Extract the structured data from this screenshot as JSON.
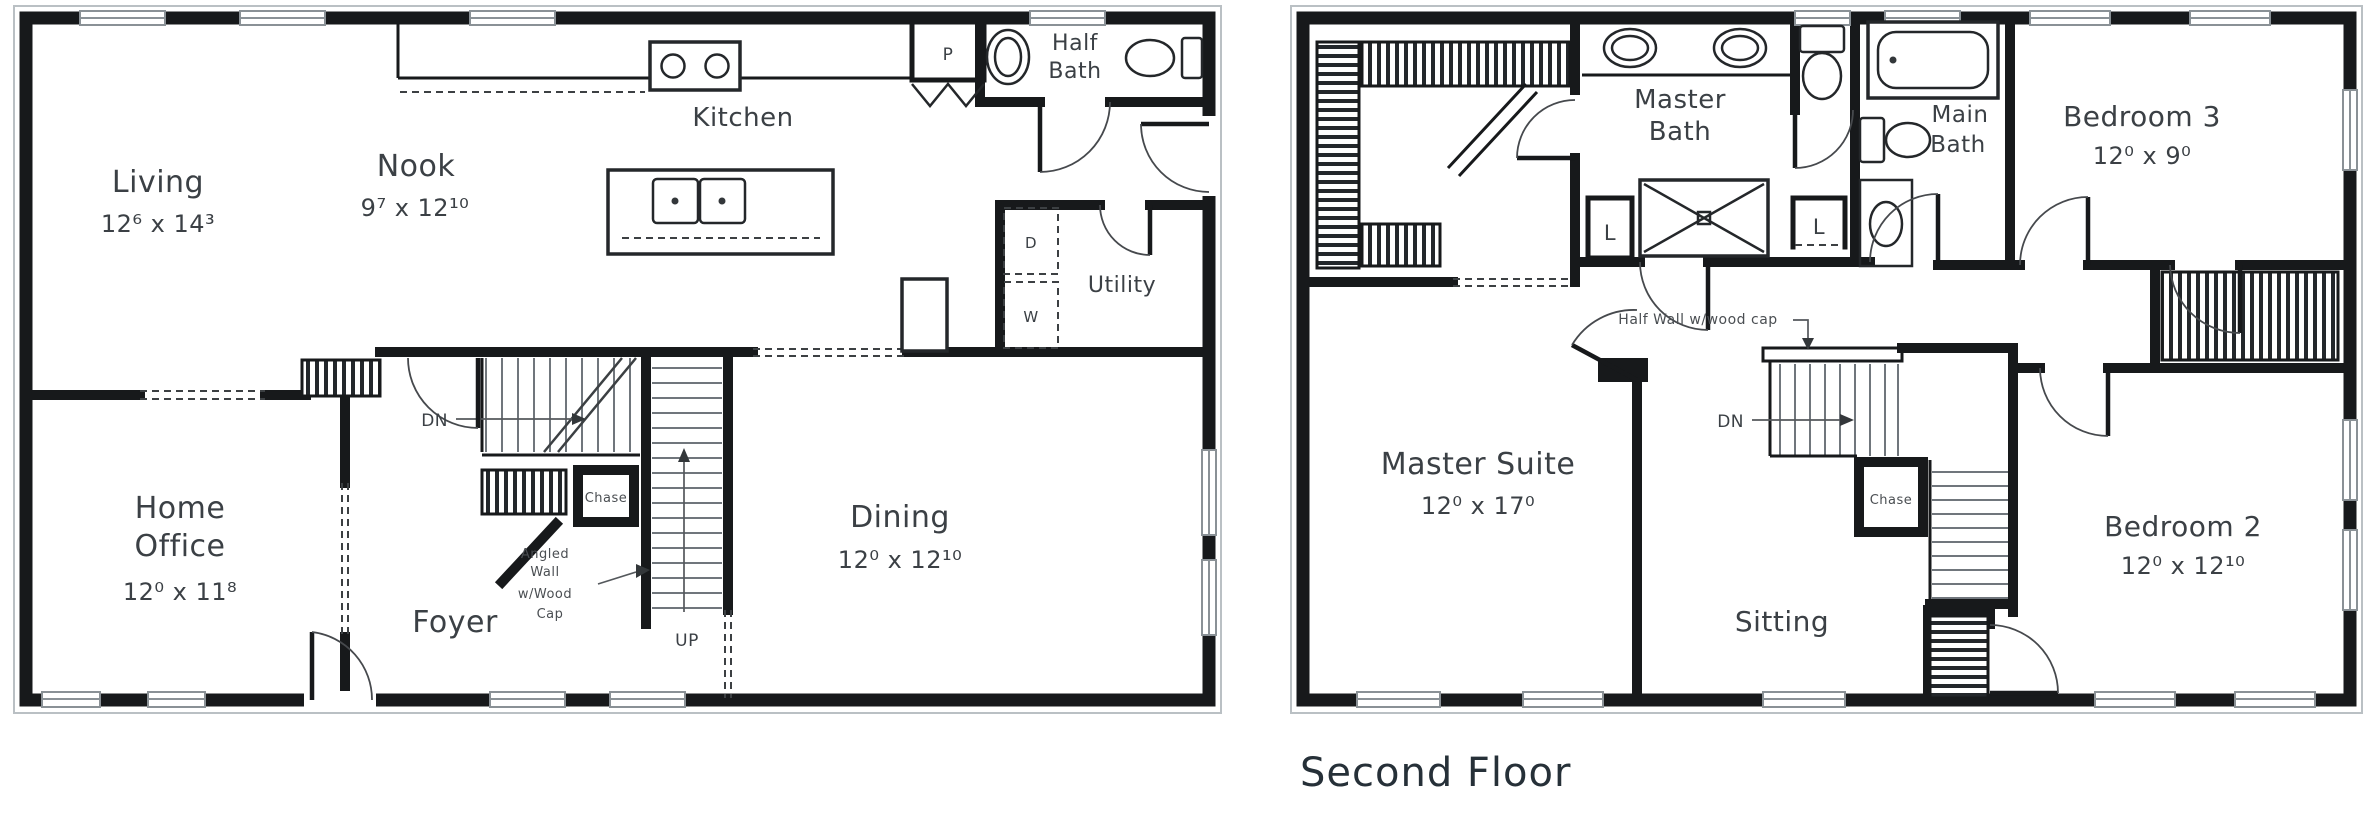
{
  "page": {
    "background": "#ffffff",
    "ink": "#17191b",
    "label_color": "#3b4045",
    "annotation_color": "#4a4e52",
    "window_color": "#8a9196"
  },
  "first_floor": {
    "rooms": {
      "living": {
        "name": "Living",
        "dims": "12⁶ x 14³"
      },
      "nook": {
        "name": "Nook",
        "dims": "9⁷ x 12¹⁰"
      },
      "kitchen": {
        "name": "Kitchen"
      },
      "half_bath": {
        "line1": "Half",
        "line2": "Bath"
      },
      "utility": {
        "name": "Utility"
      },
      "home_office": {
        "line1": "Home",
        "line2": "Office",
        "dims": "12⁰ x 11⁸"
      },
      "foyer": {
        "name": "Foyer"
      },
      "dining": {
        "name": "Dining",
        "dims": "12⁰ x 12¹⁰"
      }
    },
    "fixtures": {
      "pantry": "P",
      "dryer": "D",
      "washer": "W"
    },
    "stairs": {
      "down": "DN",
      "up": "UP",
      "chase": "Chase"
    },
    "annotations": {
      "angled_wall": [
        "Angled",
        "Wall",
        "w/Wood",
        "Cap"
      ]
    }
  },
  "second_floor": {
    "rooms": {
      "master_bath": {
        "line1": "Master",
        "line2": "Bath"
      },
      "main_bath": {
        "line1": "Main",
        "line2": "Bath"
      },
      "bedroom_3": {
        "name": "Bedroom 3",
        "dims": "12⁰ x 9⁰"
      },
      "master_suite": {
        "name": "Master Suite",
        "dims": "12⁰ x 17⁰"
      },
      "sitting": {
        "name": "Sitting"
      },
      "bedroom_2": {
        "name": "Bedroom 2",
        "dims": "12⁰ x 12¹⁰"
      }
    },
    "closets": {
      "linen_1": "L",
      "linen_2": "L"
    },
    "stairs": {
      "down": "DN",
      "chase": "Chase"
    },
    "annotations": {
      "half_wall": "Half Wall w/wood cap"
    },
    "caption": "Second Floor"
  }
}
